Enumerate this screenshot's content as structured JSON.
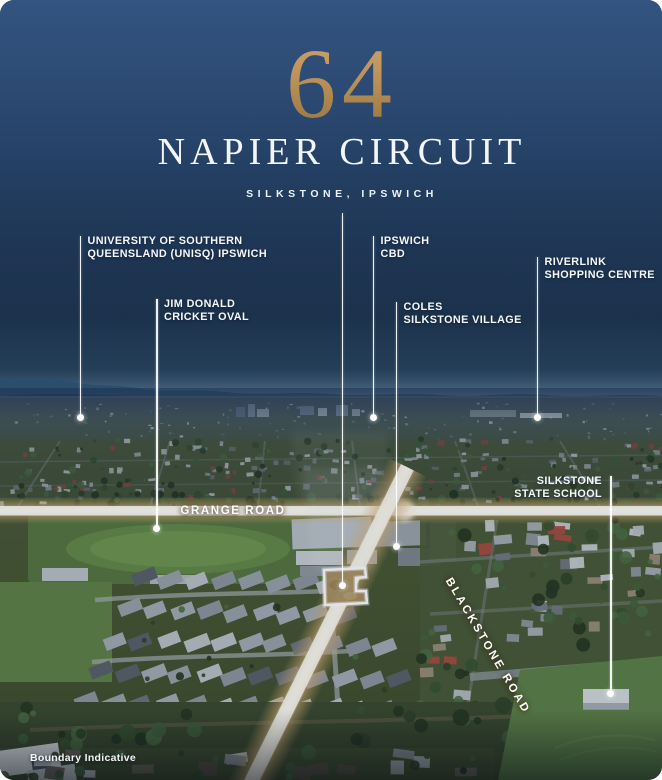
{
  "header": {
    "street_number": "64",
    "street_name": "NAPIER CIRCUIT",
    "suburb_line": "SILKSTONE, IPSWICH"
  },
  "callouts": [
    {
      "id": "unisq",
      "line1": "UNIVERSITY OF SOUTHERN",
      "line2": "QUEENSLAND (UNISQ) IPSWICH"
    },
    {
      "id": "jim-donald-oval",
      "line1": "JIM DONALD",
      "line2": "CRICKET OVAL"
    },
    {
      "id": "ipswich-cbd",
      "line1": "IPSWICH",
      "line2": "CBD"
    },
    {
      "id": "coles-silkstone",
      "line1": "COLES",
      "line2": "SILKSTONE VILLAGE"
    },
    {
      "id": "riverlink",
      "line1": "RIVERLINK",
      "line2": "SHOPPING CENTRE"
    },
    {
      "id": "silkstone-school",
      "line1": "SILKSTONE",
      "line2": "STATE SCHOOL"
    }
  ],
  "roads": {
    "grange": "GRANGE ROAD",
    "blackstone": "BLACKSTONE ROAD"
  },
  "disclaimer": "Boundary Indicative",
  "colors": {
    "sky_navy": "#2e4d77",
    "gold_numeral": "#bb9159",
    "label_text": "#f5f7f9",
    "road_glow": "#d8b078",
    "property_lot_fill": "#aa9060"
  }
}
